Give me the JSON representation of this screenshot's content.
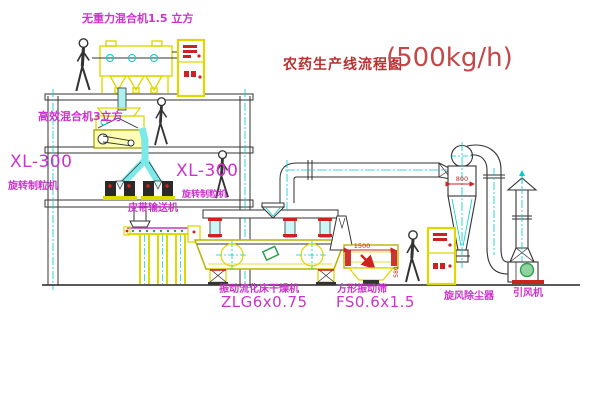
{
  "title": {
    "name_cn": "农药生产线流程图",
    "capacity": "(500kg/h)"
  },
  "labels": {
    "gravity_mixer": "无重力混合机1.5 立方",
    "high_eff_mixer": "高效混合机3立方",
    "granulator_model_left": "XL-300",
    "granulator_name_left": "旋转制粒机",
    "granulator_model_right": "XL-300",
    "granulator_name_right": "旋转制粒机",
    "belt_conveyor": "皮带输送机",
    "dryer_name": "振动流化床干燥机",
    "dryer_model": "ZLG6x0.75",
    "sieve_name": "方形振动筛",
    "sieve_model": "FS0.6x1.5",
    "cyclone": "旋风除尘器",
    "fan": "引风机"
  },
  "dimensions": {
    "cyclone_width": "800",
    "sieve_length": "1500",
    "sieve_height": "580"
  },
  "colors": {
    "label_magenta": "#cc33cc",
    "title_red": "#b83232",
    "machine_yellow": "#ddd800",
    "centerline_cyan": "#00cccc",
    "line_dark": "#333333",
    "dimension_red": "#cc2222",
    "motor_green": "#2e9e4f"
  }
}
